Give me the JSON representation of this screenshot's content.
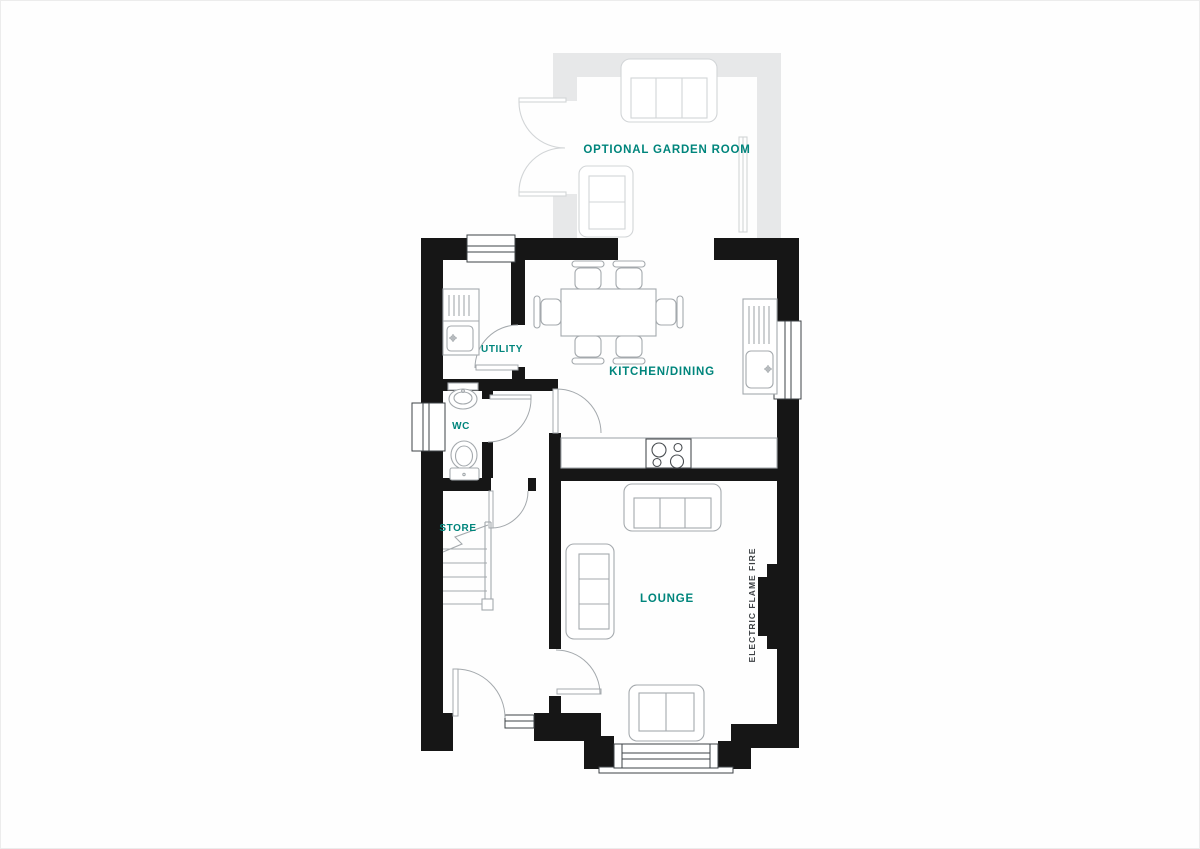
{
  "plan": {
    "labels": {
      "garden_room": "OPTIONAL GARDEN ROOM",
      "utility": "UTILITY",
      "kitchen_dining": "KITCHEN/DINING",
      "wc": "WC",
      "store": "STORE",
      "lounge": "LOUNGE",
      "fire_note": "ELECTRIC FLAME FIRE"
    },
    "colors": {
      "label_accent": "#00857C",
      "wall": "#161616",
      "ghost_wall": "#e7e8e9",
      "furniture_line": "#a4a9ad",
      "annotation": "#3c4043",
      "background": "#fefefe"
    }
  }
}
